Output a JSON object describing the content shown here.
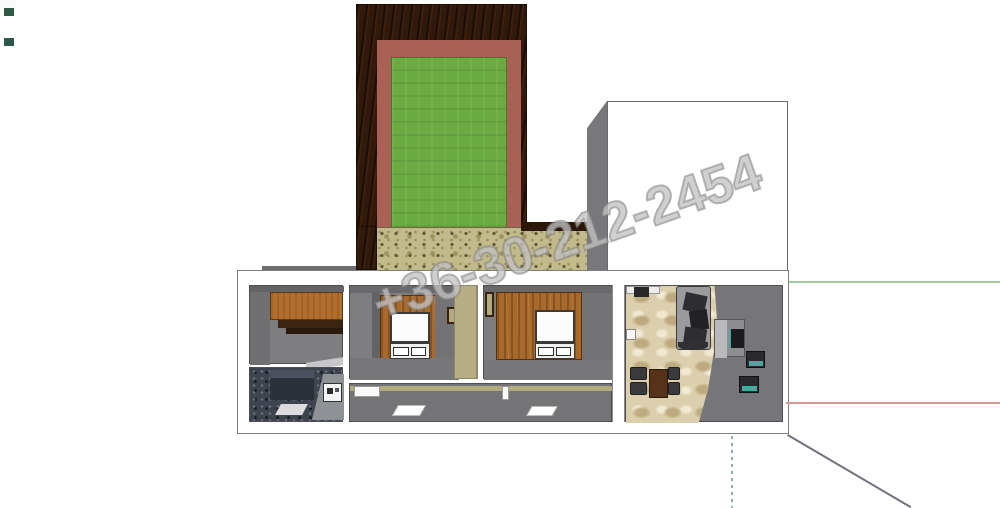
{
  "watermark": {
    "text": "+36-30-212-2454"
  },
  "theme": {
    "frame_dark": "#31190b",
    "frame_salmon": "#a96156",
    "grass_green": "#6cab42",
    "cork_tan": "#c3ba8b",
    "box_gray_face": "#78787a",
    "room_gray": "#7e7e80",
    "floor_gray": "#747476",
    "wood_wall": "#a8692d",
    "cabinet_orange": "#b06f2e",
    "cabinet_dark": "#3c2412",
    "utility_dark": "#3e444d",
    "carpet_tan": "#dccfad",
    "hall_tan": "#b7ae85",
    "sofa_base": "#9b9b9d",
    "cushion_dark": "#2e2e32",
    "table_brown": "#57321b",
    "chair_dark": "#3a3a3e",
    "teal_accent": "#4ba7a0",
    "axis_green": "#a6c8a2",
    "axis_red": "#d49a9a",
    "axis_teal": "#8ab3a9",
    "guide_gray": "#70707e",
    "wm_fill": "rgba(222,222,222,0.55)",
    "wm_stroke": "rgba(125,125,125,0.5)"
  }
}
